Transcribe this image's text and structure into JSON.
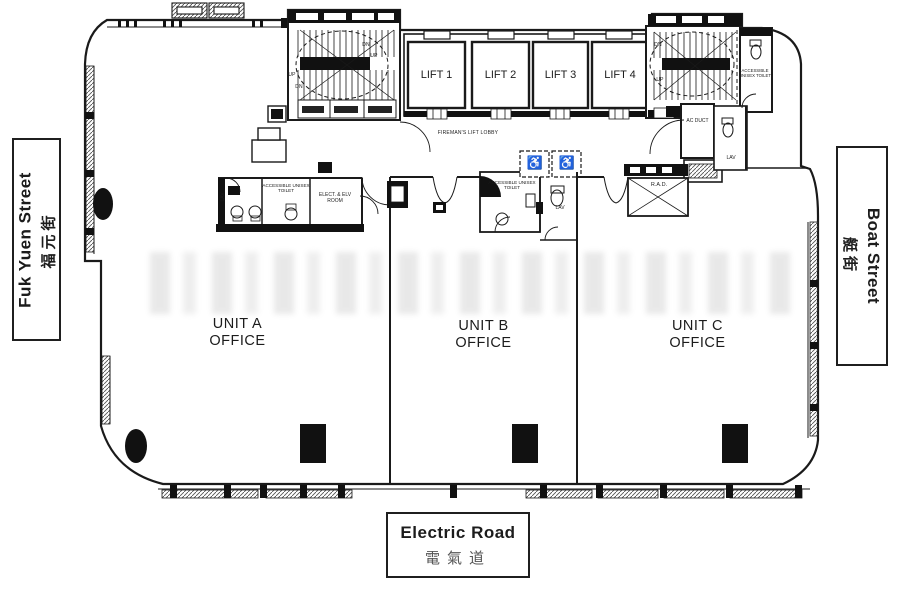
{
  "plan": {
    "streets": {
      "left": {
        "en": "Fuk Yuen Street",
        "zh": "福元街"
      },
      "right": {
        "en": "Boat Street",
        "zh": "艇街"
      },
      "bottom": {
        "en": "Electric Road",
        "zh": "電氣道"
      }
    },
    "units": [
      {
        "line1": "UNIT A",
        "line2": "OFFICE"
      },
      {
        "line1": "UNIT B",
        "line2": "OFFICE"
      },
      {
        "line1": "UNIT C",
        "line2": "OFFICE"
      }
    ],
    "lifts": [
      "LIFT 1",
      "LIFT 2",
      "LIFT 3",
      "LIFT 4"
    ],
    "labels": {
      "fireman_lobby": "FIREMAN'S LIFT LOBBY",
      "accessible_toilet": "ACCESSIBLE UNISEX TOILET",
      "elect_elv_room": "ELECT. & ELV ROOM",
      "ac_duct": "AC DUCT",
      "lav": "LAV",
      "rad": "R.A.D.",
      "up": "UP",
      "dn": "DN",
      "wheelchair_icon": "♿"
    }
  }
}
